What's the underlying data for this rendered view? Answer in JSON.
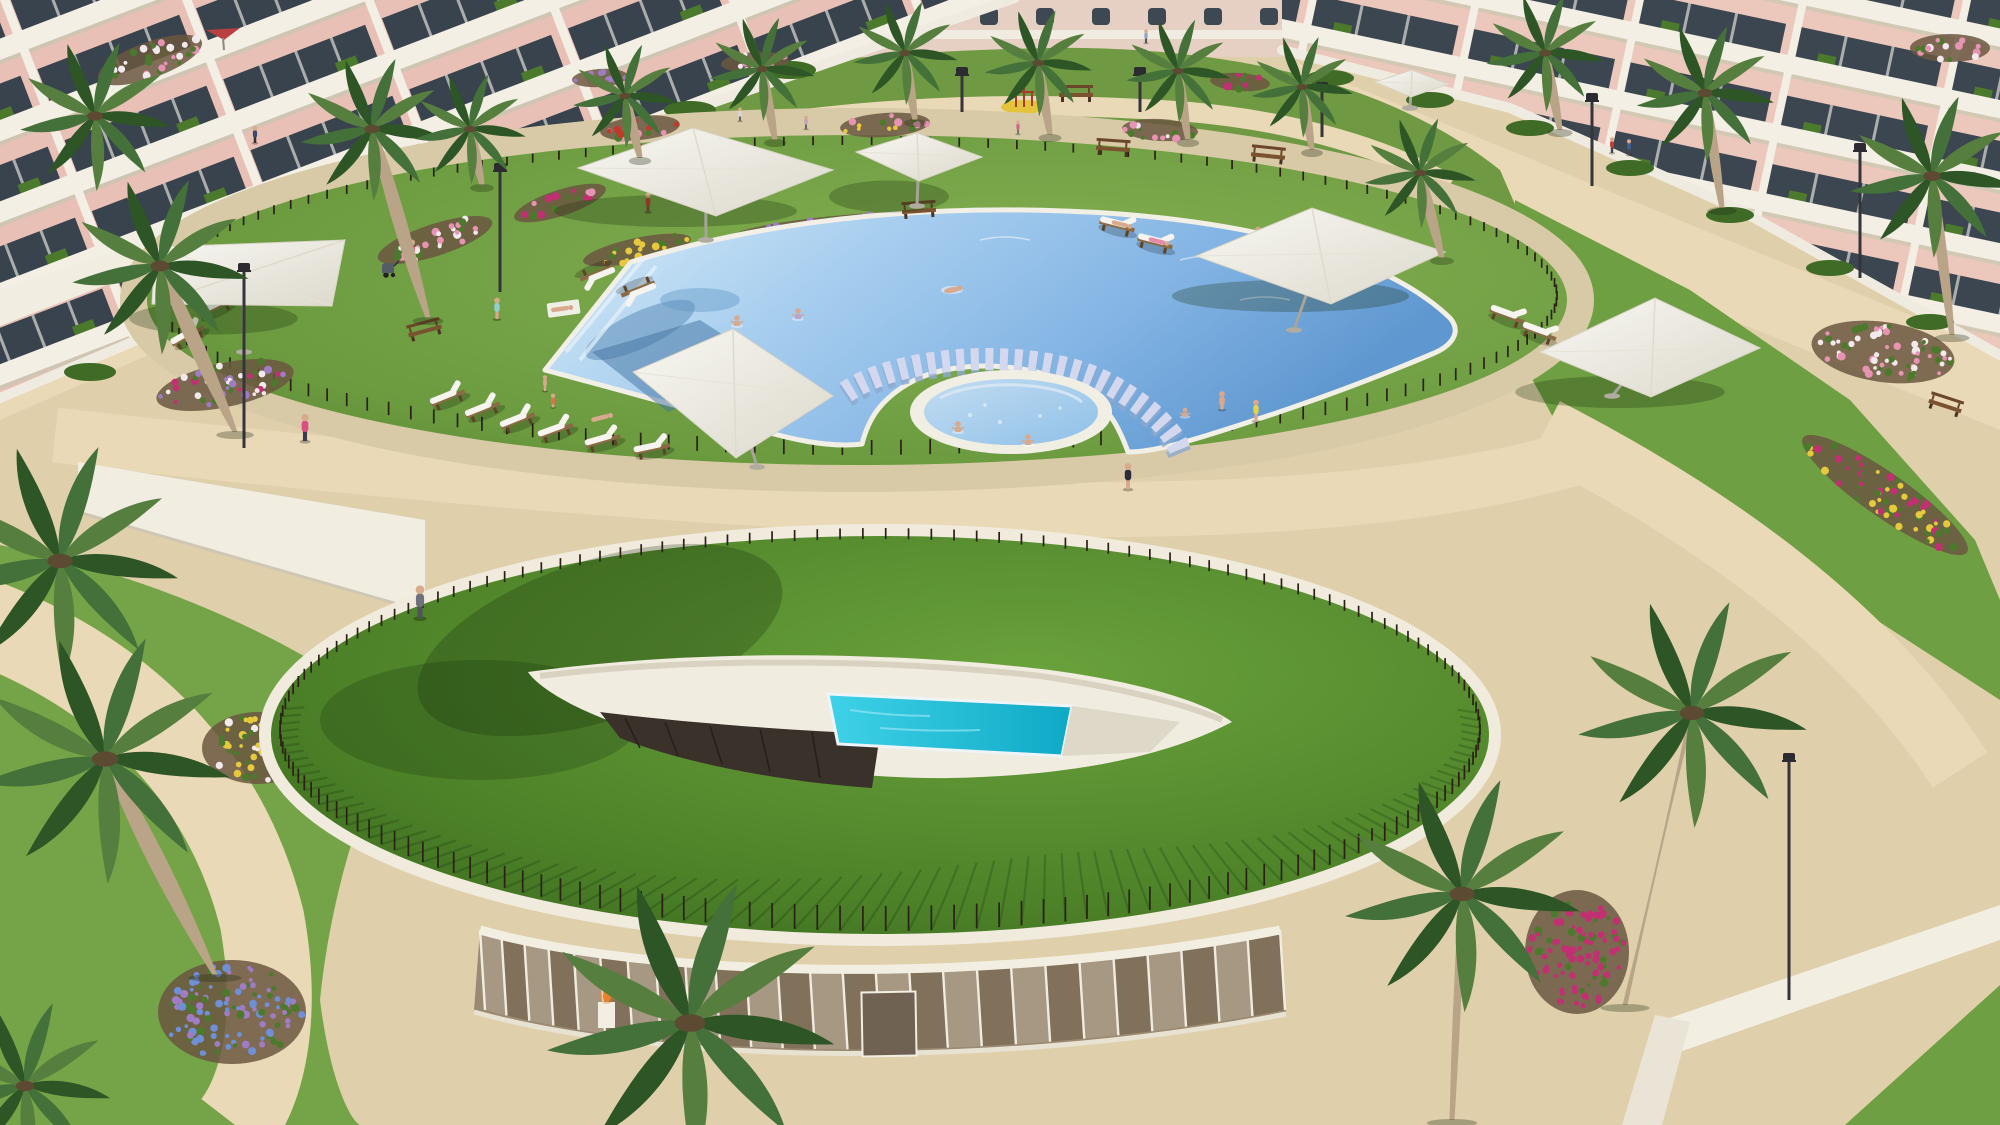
{
  "meta": {
    "title": "Aerial architectural rendering of a resort-style residential complex",
    "type": "3d-render",
    "visible_text": "none"
  },
  "scene": {
    "description": "Bird's-eye 3D visualization of an apartment complex courtyard: pink low-rise apartment buildings with white balconies surround a landscaped garden. An oval pool deck holds a large crescent-shaped lagoon pool with a swim-through colonnade of columns, a round jacuzzi on a grass island and a large white shade sail. In front, a circular green-roofed spa pavilion has an eye-shaped skylight revealing an indoor turquoise pool above a curved glass facade. Sandy paths, palm trees, flower beds, wooden sun loungers, white parasols, benches, street lamps and small human figures complete the sunny scene.",
    "time_of_day": "sunny daytime",
    "objects": {
      "buildings": "pink apartment blocks with white balconies (left, right, background)",
      "main_pool": "crescent lagoon pool with column swim colonnade",
      "jacuzzi": "round whirlpool pool ringed in white",
      "indoor_pool": "turquoise pool under an eye-shaped skylight cut into a green roof mound",
      "spa_pavilion": "curved glass facade with white mullions under the planted roof",
      "shade_structures": "7 white square parasols and shade sails",
      "palm_trees": "about 20 palms of various sizes",
      "people": "about 30 residents sunbathing, swimming, walking, in jacuzzi",
      "furniture": "wooden sun loungers with white cushions, park benches, a baby stroller",
      "lighting": "dark modern street lamps",
      "flowers": "pink, magenta, yellow, blue, purple and white flower beds",
      "fences": "thin dark picket fences around the pool deck and the roof mound",
      "fire_feature": "small orange fire bowl behind the glass facade"
    },
    "palette": {
      "sand": "#dfd0ab",
      "sandLight": "#ead9b6",
      "stone": "#d8caa7",
      "stoneEdge": "#c0ae8b",
      "grass": "#6f9f43",
      "grassDark": "#4a7627",
      "poolLight": "#d7ebf8",
      "poolMid": "#8fc0ea",
      "poolDeep": "#5f98d0",
      "curtain": "#d3d8ee",
      "innerPool": "#27c2dd",
      "white": "#f2eee2",
      "pinkWall": "#e9c0b6",
      "glassDark": "#39434d",
      "fence": "#2a2015",
      "wood": "#8a6b45",
      "woodDark": "#5d4426",
      "trunk": "#b9a488",
      "palmDark": "#2e5526",
      "palmMid": "#44703a",
      "palmLight": "#567f3f",
      "soil": "#6b5741",
      "flowerPink": "#e794b4",
      "flowerMagenta": "#c22f72",
      "flowerYellow": "#e7c93e",
      "flowerBlue": "#6f8fd6",
      "flowerPurple": "#9f7cc4",
      "flowerWhite": "#f2e9ec",
      "flowerRed": "#c0392b",
      "skin": "#d8a98c",
      "umbrella": "#f6f4ee",
      "poleGray": "#a7a49c",
      "lampDark": "#34343a",
      "orange": "#e8822c"
    }
  }
}
